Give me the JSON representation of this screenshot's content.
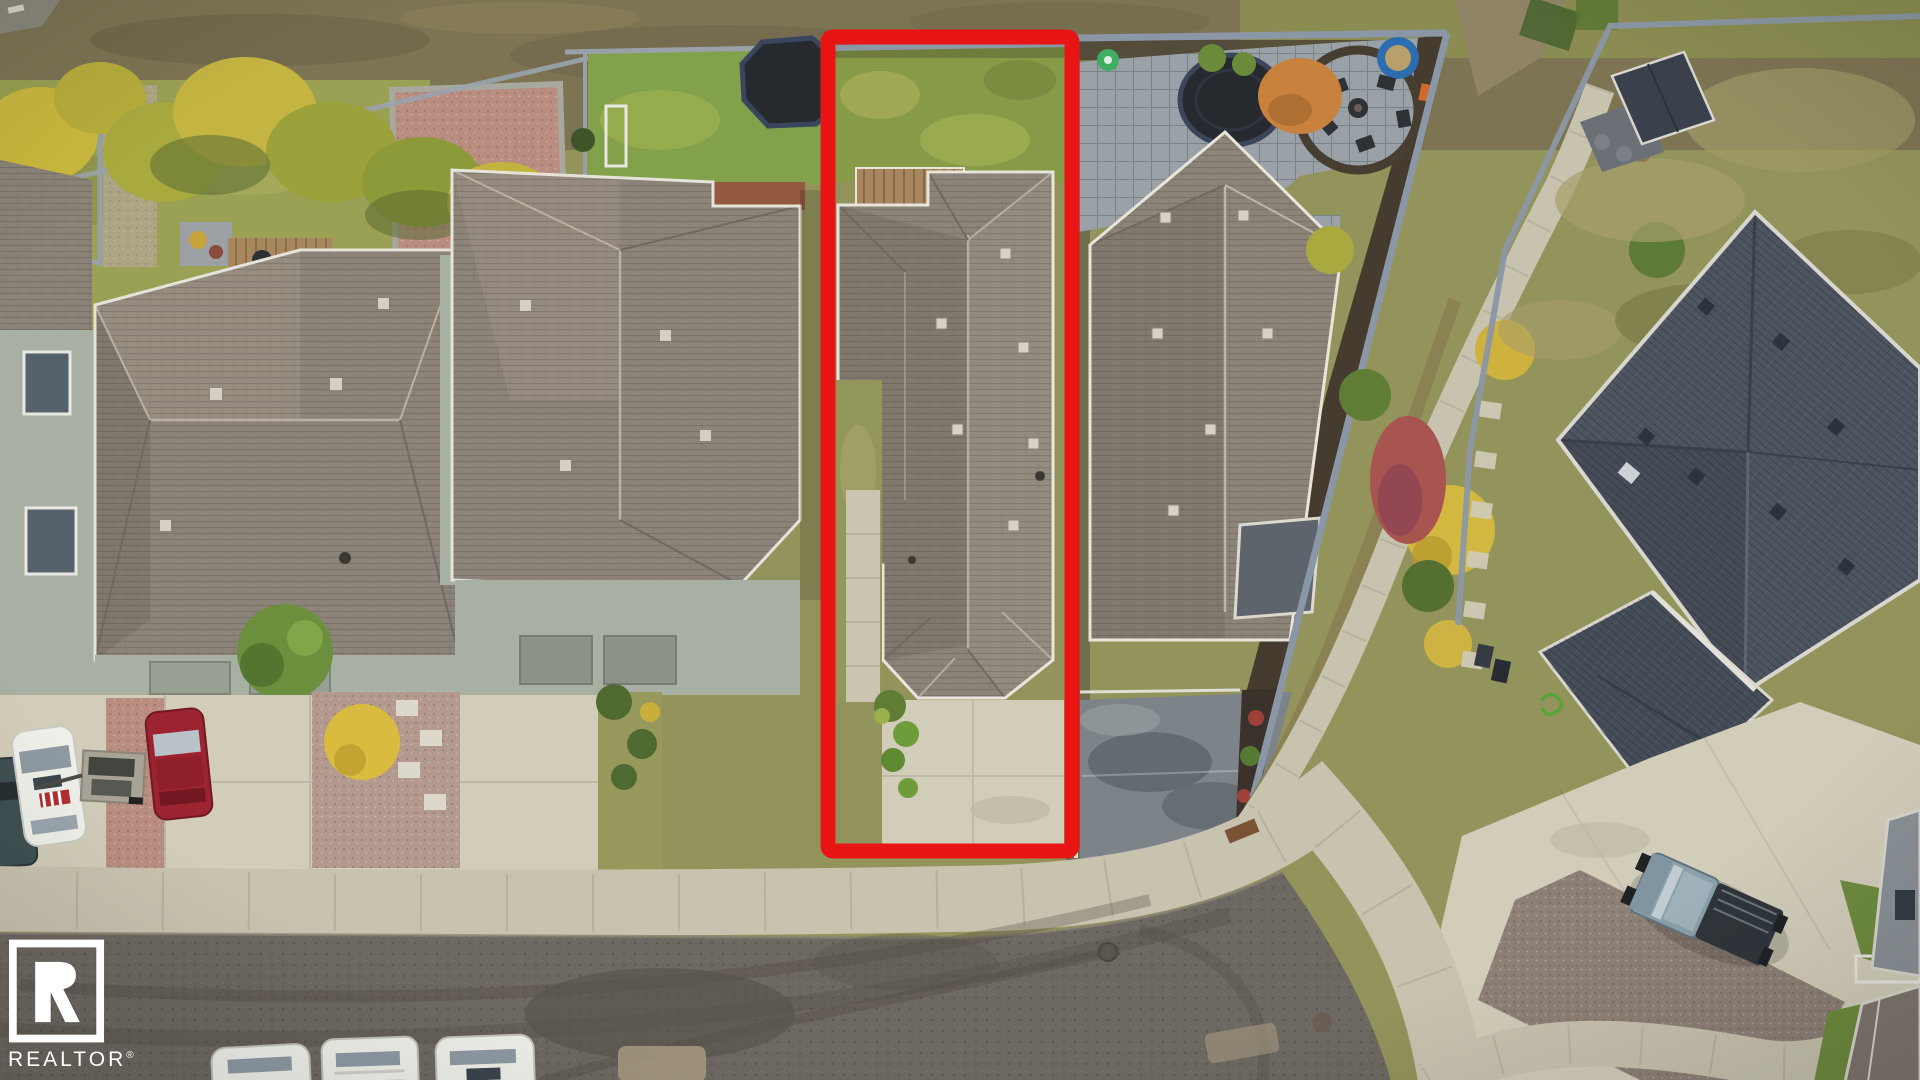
{
  "watermark": {
    "brand": "REALTOR",
    "reg": "®"
  },
  "colors": {
    "lot_outline_red": "#e91515",
    "watermark_white": "#ffffff",
    "asphalt_gray": "#6d6861",
    "concrete_light": "#d2cdb9",
    "sidewalk_concrete": "#c8c3af",
    "roof_warm_gray": "#8c8478",
    "roof_dark_slate": "#4c5460",
    "wall_sage_green": "#a7b0a2",
    "lawn_green": "#83a04b",
    "grass_olive": "#93935c",
    "dirt_field_brown": "#7d7454",
    "paver_gray": "#9aa1a7",
    "gravel_pink": "#b98e80",
    "fence_blue_gray": "#8b97a6",
    "tree_yellow": "#d2b840",
    "tree_orange": "#c8823d",
    "shrub_green": "#5f7d35",
    "deck_wood_brown": "#a8875f",
    "trampoline_black": "#26292e",
    "car_red": "#9c2430",
    "car_white": "#efefe9",
    "truck_blue_gray": "#8ba0aa",
    "stain_dark": "#5c646a"
  }
}
